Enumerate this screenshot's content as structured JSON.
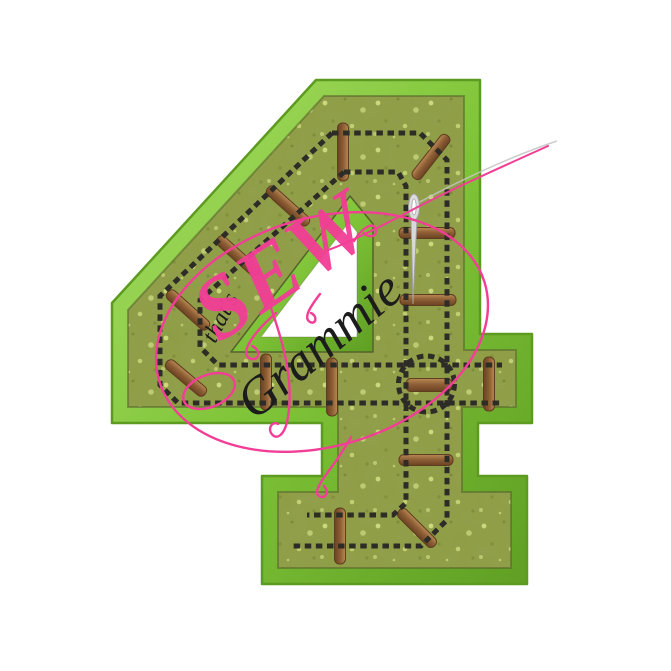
{
  "image": {
    "type": "embroidery-applique-product-mockup",
    "background": "#ffffff"
  },
  "applique": {
    "digit": "4",
    "motif": "train-track",
    "border_color": "#7fc438",
    "fabric_color": "#8e9d44",
    "rail_color": "#2d2c27",
    "tie_color": "#8f5f36",
    "hole_color": "#ffffff"
  },
  "watermark": {
    "word_small": "that's",
    "word_main": "SEW",
    "word_sub": "Grammie",
    "pink": "#f23e96",
    "ink": "#1c1c1c",
    "needle_gray": "#c4c4c4"
  }
}
